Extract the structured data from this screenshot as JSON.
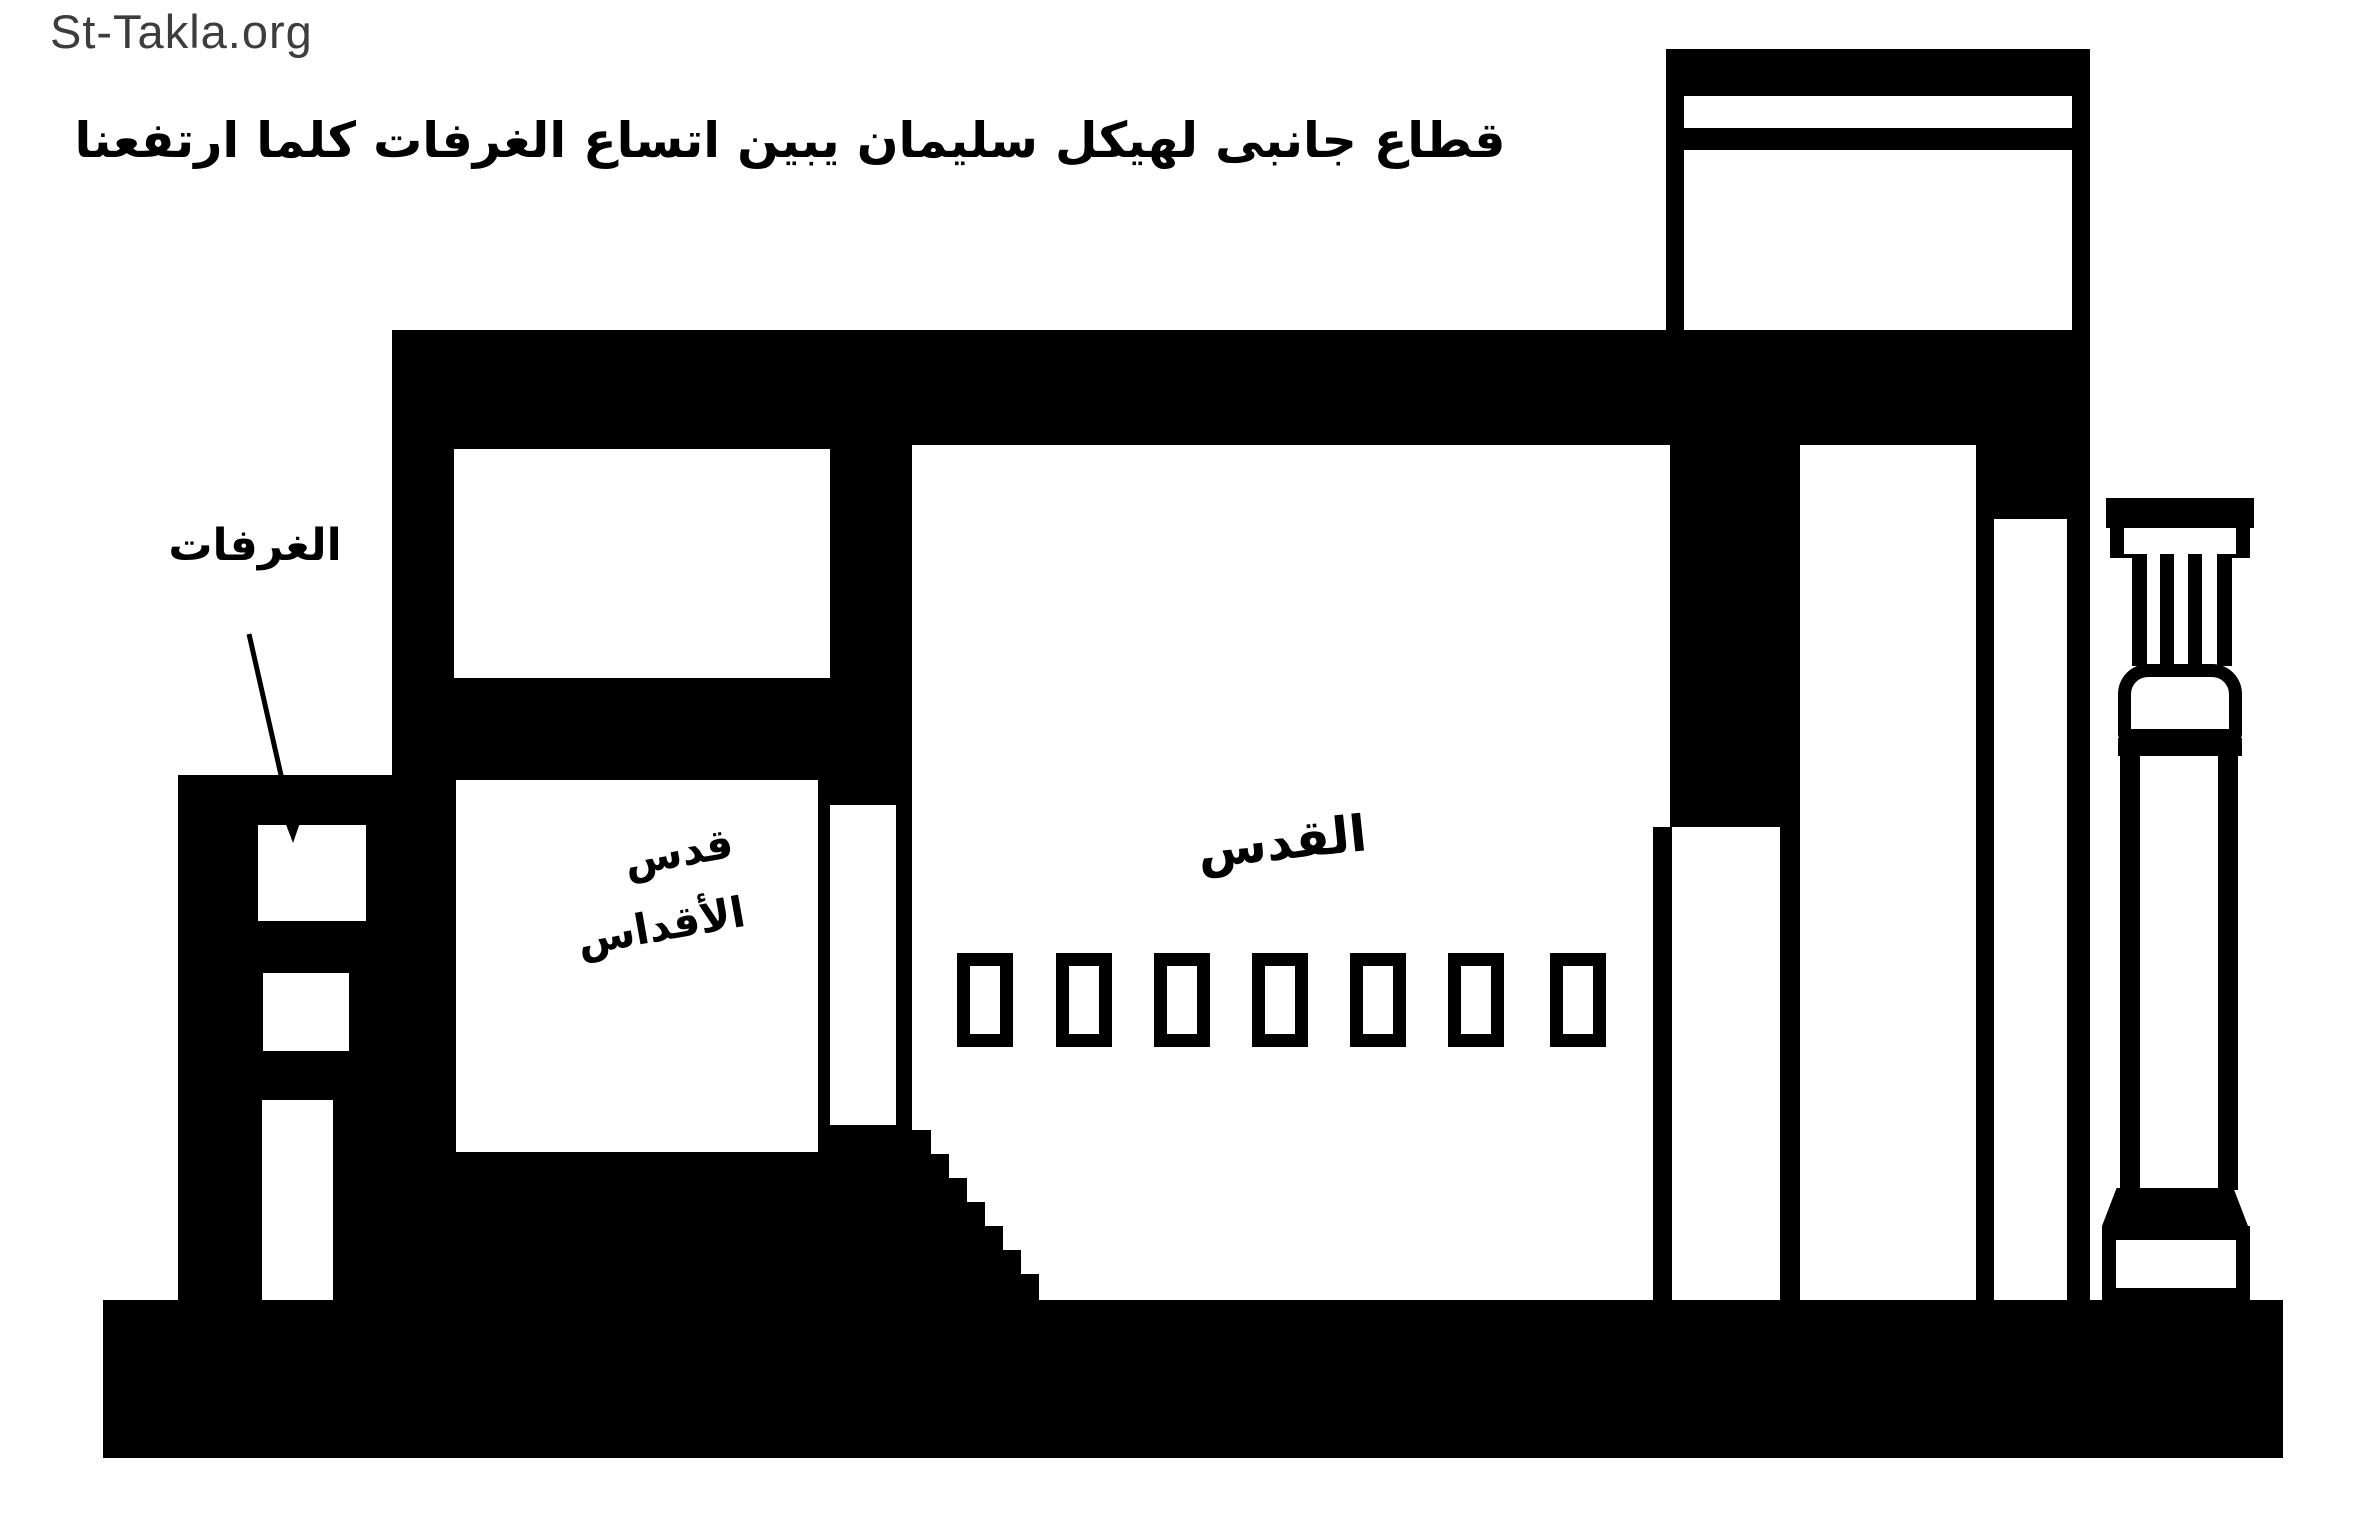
{
  "site": {
    "watermark": "St-Takla.org"
  },
  "title": "قطاع جانبى لهيكل سليمان يبين اتساع الغرفات كلما ارتفعنا",
  "labels": {
    "side_rooms": "الغرفات",
    "holy_of_holies_line1": "قدس",
    "holy_of_holies_line2": "الأقداس",
    "holy_place": "القدس"
  },
  "colors": {
    "ink": "#000000",
    "background": "#ffffff",
    "watermark_gray": "#3d3d3d"
  },
  "diagram": {
    "clerestory_windows_count": 7,
    "side_chamber_windows_count": 3,
    "stair_steps": 7
  }
}
